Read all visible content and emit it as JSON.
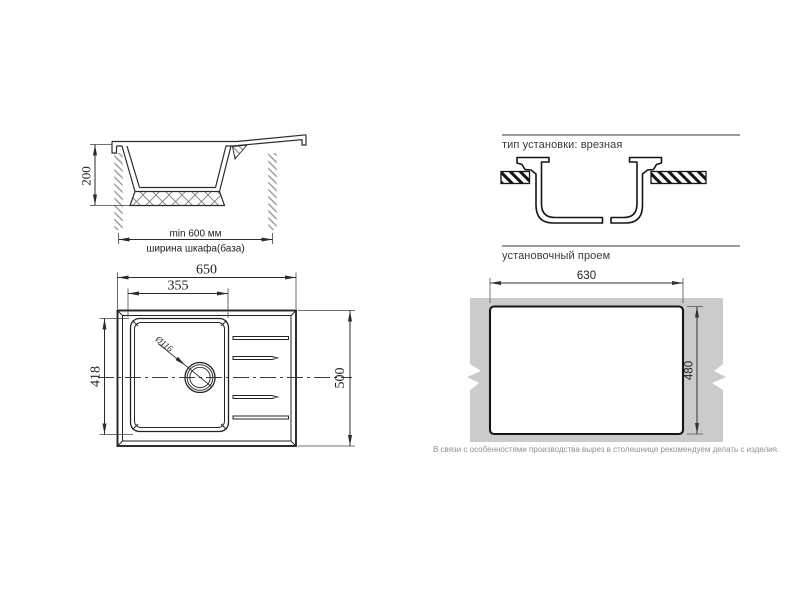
{
  "side_view": {
    "dim_height": "200",
    "min_width_label": "min 600 мм",
    "cabinet_width_label": "ширина шкафа(база)"
  },
  "top_view": {
    "dim_overall_width": "650",
    "dim_bowl_width": "355",
    "dim_bowl_depth": "418",
    "dim_overall_depth": "500",
    "drain_diameter_label": "Ø116"
  },
  "install_type": {
    "heading": "тип установки: врезная"
  },
  "cutout": {
    "heading": "установочный проем",
    "dim_width": "630",
    "dim_depth": "480",
    "note": "В связи с особенностями производства вырез в столешнице рекомендуем делать с изделия."
  },
  "colors": {
    "line": "#2b2b2b",
    "heading_rule": "#9c9c9c",
    "countertop_gray": "#cbcbcb",
    "note_text": "#8f8f8f"
  }
}
